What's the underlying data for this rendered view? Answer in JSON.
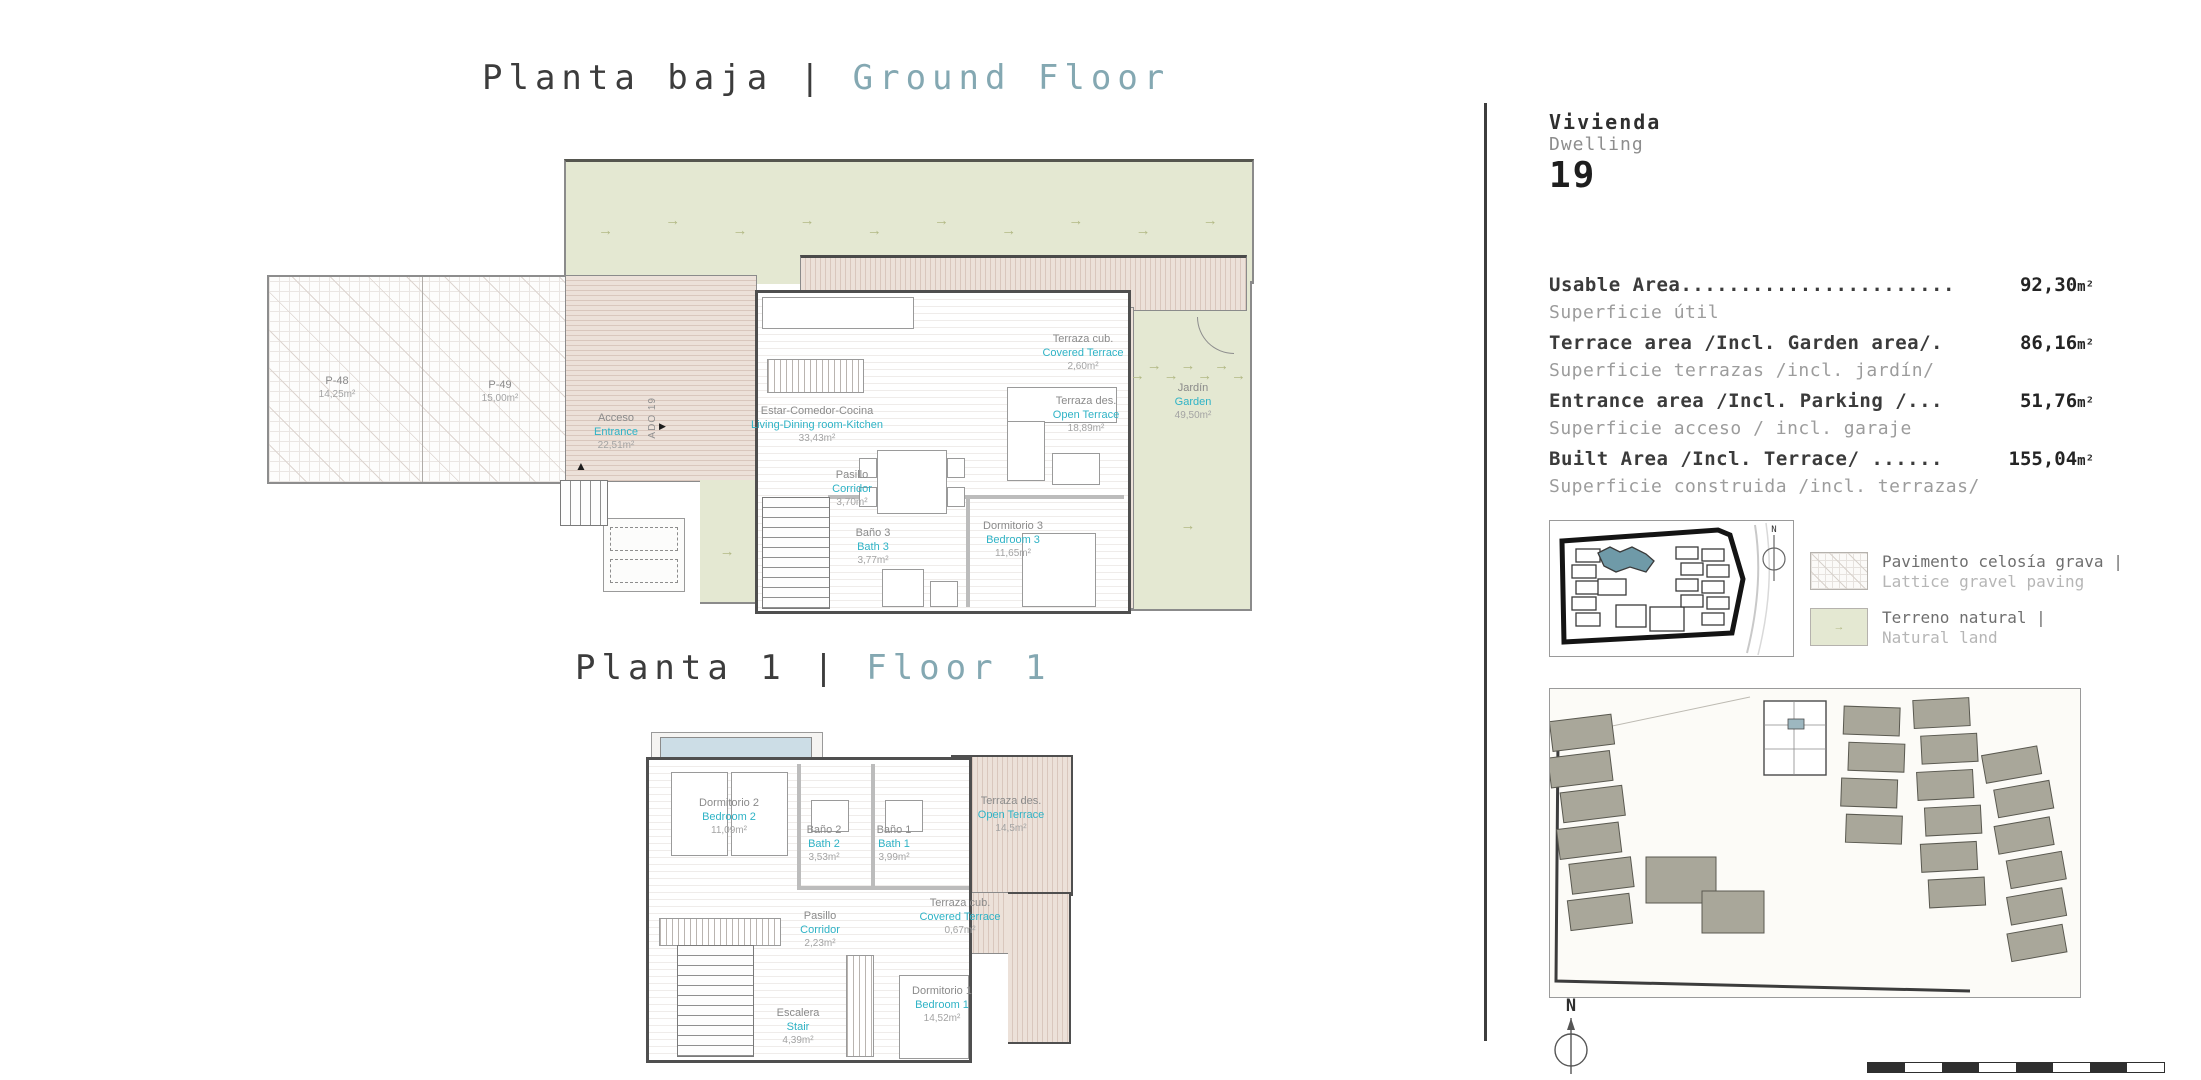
{
  "titles": {
    "ground": {
      "es": "Planta baja",
      "sep": "|",
      "en": "Ground Floor"
    },
    "floor1": {
      "es": "Planta 1",
      "sep": "|",
      "en": "Floor 1"
    }
  },
  "dwelling": {
    "es": "Vivienda",
    "en": "Dwelling",
    "number": "19"
  },
  "areas": [
    {
      "label": "Usable Area.......................",
      "value": "92,30",
      "unit": "m²",
      "sub": "Superficie útil"
    },
    {
      "label": "Terrace area /Incl. Garden area/.",
      "value": "86,16",
      "unit": "m²",
      "sub": "Superficie terrazas /incl. jardín/"
    },
    {
      "label": "Entrance area /Incl. Parking /...",
      "value": "51,76",
      "unit": "m²",
      "sub": "Superficie acceso / incl. garaje"
    },
    {
      "label": "Built Area /Incl. Terrace/ ......",
      "value": "155,04",
      "unit": "m²",
      "sub": "Superficie construida /incl. terrazas/"
    }
  ],
  "legend": [
    {
      "es": "Pavimento celosía grava |",
      "en": "Lattice gravel paving"
    },
    {
      "es": "Terreno natural |",
      "en": "Natural land"
    }
  ],
  "minimap": {
    "n": "N"
  },
  "compass": {
    "n": "N"
  },
  "icons": {
    "arrow": "→",
    "marker": "▶",
    "up": "▲"
  },
  "plans": {
    "ground": {
      "rooms": {
        "p48": {
          "es": "P-48",
          "val": "14,25m²"
        },
        "p49": {
          "es": "P-49",
          "val": "15,00m²"
        },
        "entrance": {
          "es": "Acceso",
          "en": "Entrance",
          "val": "22,51m²"
        },
        "ado": {
          "label": "ADO 19"
        },
        "living": {
          "es": "Estar-Comedor-Cocina",
          "en": "Living-Dining room-Kitchen",
          "val": "33,43m²"
        },
        "corridor": {
          "es": "Pasillo",
          "en": "Corridor",
          "val": "3,70m²"
        },
        "bath3": {
          "es": "Baño 3",
          "en": "Bath 3",
          "val": "3,77m²"
        },
        "bed3": {
          "es": "Dormitorio 3",
          "en": "Bedroom 3",
          "val": "11,65m²"
        },
        "covered": {
          "es": "Terraza cub.",
          "en": "Covered Terrace",
          "val": "2,60m²"
        },
        "open": {
          "es": "Terraza des.",
          "en": "Open Terrace",
          "val": "18,89m²"
        },
        "garden": {
          "es": "Jardín",
          "en": "Garden",
          "val": "49,50m²"
        }
      }
    },
    "floor1": {
      "rooms": {
        "bed2": {
          "es": "Dormitorio 2",
          "en": "Bedroom 2",
          "val": "11,09m²"
        },
        "bath2": {
          "es": "Baño 2",
          "en": "Bath 2",
          "val": "3,53m²"
        },
        "bath1": {
          "es": "Baño 1",
          "en": "Bath 1",
          "val": "3,99m²"
        },
        "open": {
          "es": "Terraza des.",
          "en": "Open Terrace",
          "val": "14,5m²"
        },
        "covered": {
          "es": "Terraza cub.",
          "en": "Covered Terrace",
          "val": "0,67m²"
        },
        "corridor": {
          "es": "Pasillo",
          "en": "Corridor",
          "val": "2,23m²"
        },
        "bed1": {
          "es": "Dormitorio 1",
          "en": "Bedroom 1",
          "val": "14,52m²"
        },
        "stair": {
          "es": "Escalera",
          "en": "Stair",
          "val": "4,39m²"
        }
      }
    }
  },
  "colors": {
    "accent_teal": "#2fb3c6",
    "title_teal": "#84a8b2",
    "natural_land": "#e4e8d2",
    "terrace_stripe": "#d9c7bd",
    "map_highlight": "#6f9aa8"
  }
}
